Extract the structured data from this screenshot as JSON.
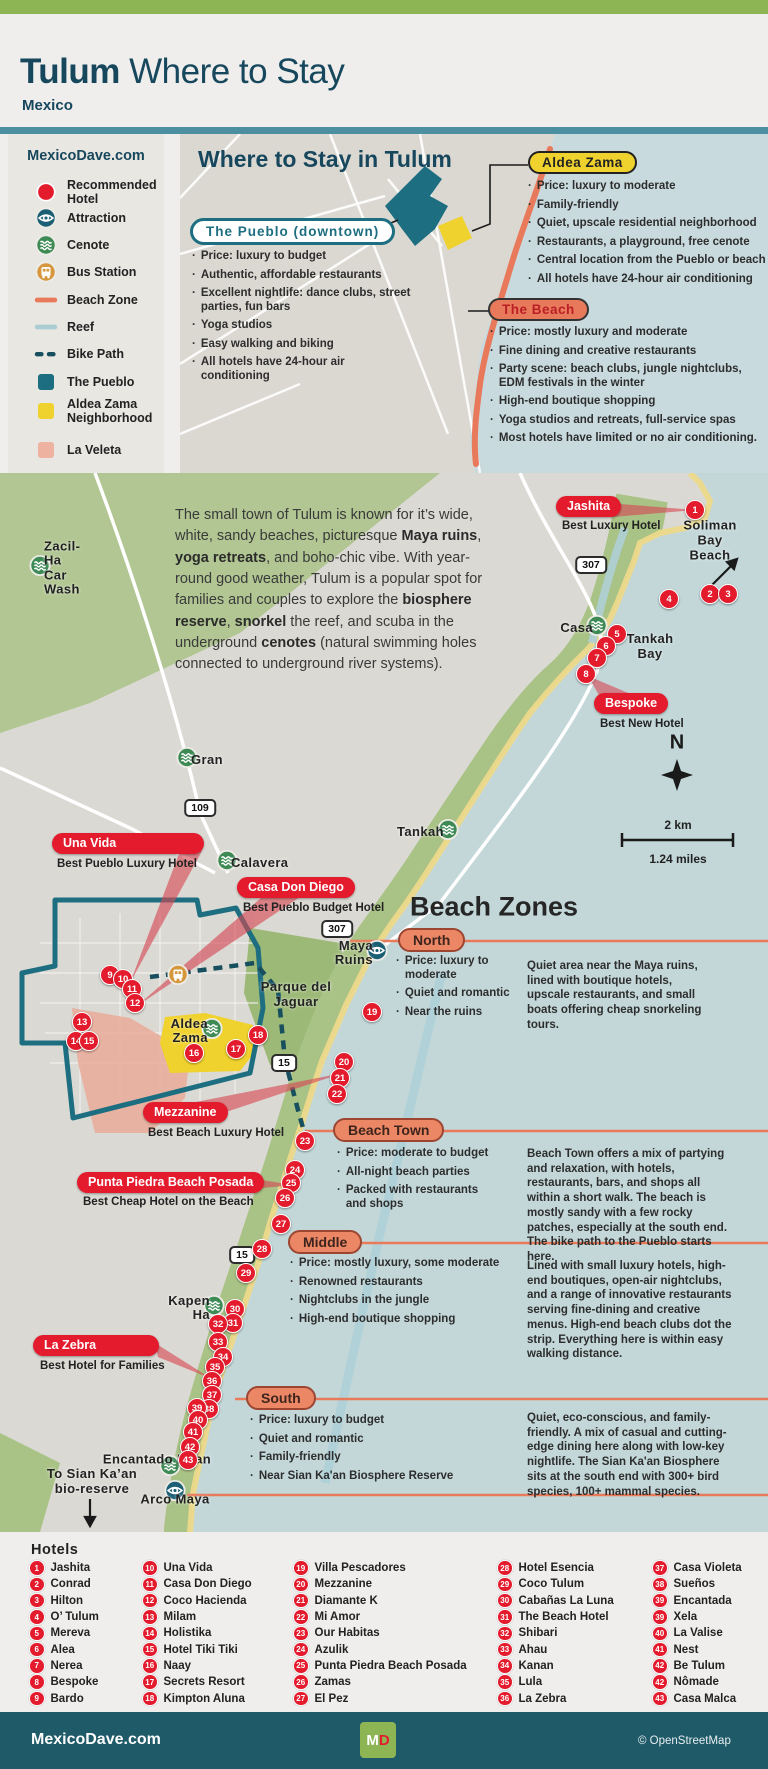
{
  "header": {
    "title_bold": "Tulum",
    "title_rest": " Where to Stay",
    "subtitle": "Mexico"
  },
  "legend": {
    "site": "MexicoDave.com",
    "items": [
      {
        "icon": "hotel",
        "label": "Recommended Hotel"
      },
      {
        "icon": "attraction",
        "label": "Attraction"
      },
      {
        "icon": "cenote",
        "label": "Cenote"
      },
      {
        "icon": "bus",
        "label": "Bus Station"
      },
      {
        "icon": "beachzone",
        "label": "Beach Zone"
      },
      {
        "icon": "reef",
        "label": "Reef"
      },
      {
        "icon": "bikepath",
        "label": "Bike Path"
      },
      {
        "icon": "pueblo",
        "label": "The Pueblo"
      },
      {
        "icon": "aldea",
        "label": "Aldea Zama Neighborhood"
      },
      {
        "icon": "veleta",
        "label": "La Veleta"
      }
    ]
  },
  "inset": {
    "title": "Where to Stay in Tulum",
    "pueblo": {
      "label": "The Pueblo (downtown)",
      "bullets": [
        "Price: luxury to budget",
        "Authentic, affordable restaurants",
        "Excellent nightlife: dance clubs, street parties, fun bars",
        "Yoga studios",
        "Easy walking and biking",
        "All hotels have 24-hour air conditioning"
      ]
    },
    "aldea": {
      "label": "Aldea Zama",
      "bullets": [
        "Price: luxury to moderate",
        "Family-friendly",
        "Quiet, upscale residential neighborhood",
        "Restaurants, a playground, free cenote",
        "Central location from the Pueblo or beach",
        "All hotels have 24-hour air conditioning"
      ]
    },
    "beach": {
      "label": "The Beach",
      "bullets": [
        "Price: mostly luxury and moderate",
        "Fine dining and creative restaurants",
        "Party scene: beach clubs, jungle nightclubs, EDM festivals in the winter",
        "High-end boutique shopping",
        "Yoga studios and retreats, full-service spas",
        "Most hotels have limited or no air conditioning."
      ]
    }
  },
  "map": {
    "intro_segments": [
      {
        "t": "The small town of Tulum is known for it’s wide, white, sandy beaches, picturesque ",
        "b": false
      },
      {
        "t": "Maya ruins",
        "b": true
      },
      {
        "t": ", ",
        "b": false
      },
      {
        "t": "yoga retreats",
        "b": true
      },
      {
        "t": ", and boho-chic vibe. With year-round good weather, Tulum is a popular spot for families and couples to explore the ",
        "b": false
      },
      {
        "t": "biosphere reserve",
        "b": true
      },
      {
        "t": ", ",
        "b": false
      },
      {
        "t": "snorkel",
        "b": true
      },
      {
        "t": " the reef, and scuba in the underground ",
        "b": false
      },
      {
        "t": "cenotes",
        "b": true
      },
      {
        "t": " (natural swimming holes connected to underground river systems).",
        "b": false
      }
    ],
    "callouts": [
      {
        "name": "Jashita",
        "sub": "Best Luxury Hotel"
      },
      {
        "name": "Bespoke",
        "sub": "Best New Hotel"
      },
      {
        "name": "Una Vida",
        "sub": "Best Pueblo Luxury Hotel"
      },
      {
        "name": "Casa Don Diego",
        "sub": "Best Pueblo Budget Hotel"
      },
      {
        "name": "Mezzanine",
        "sub": "Best Beach Luxury Hotel"
      },
      {
        "name": "Punta Piedra Beach Posada",
        "sub": "Best Cheap Hotel on the Beach"
      },
      {
        "name": "La Zebra",
        "sub": "Best Hotel for Families"
      }
    ],
    "zones_heading": "Beach Zones",
    "zones": [
      {
        "name": "North",
        "bullets": [
          "Price: luxury to moderate",
          "Quiet and romantic",
          "Near the ruins"
        ],
        "description": "Quiet area near the Maya ruins, lined with boutique hotels, upscale restaurants, and small boats offering cheap snorkeling tours."
      },
      {
        "name": "Beach Town",
        "bullets": [
          "Price: moderate to budget",
          "All-night beach parties",
          "Packed with restaurants and shops"
        ],
        "description": "Beach Town offers a mix of partying and relaxation, with hotels, restaurants, bars, and shops all within a short walk. The beach is mostly sandy with a few rocky patches, especially at the south end. The bike path to the Pueblo starts here."
      },
      {
        "name": "Middle",
        "bullets": [
          "Price: mostly luxury, some moderate",
          "Renowned restaurants",
          "Nightclubs in the jungle",
          "High-end boutique shopping"
        ],
        "description": "Lined with small luxury hotels, high-end boutiques, open-air nightclubs, and a range of innovative restaurants serving fine-dining and creative menus. High-end beach clubs dot the strip. Everything here is within easy walking distance."
      },
      {
        "name": "South",
        "bullets": [
          "Price: luxury to budget",
          "Quiet and romantic",
          "Family-friendly",
          "Near Sian Ka'an Biosphere Reserve"
        ],
        "description": "Quiet, eco-conscious, and family-friendly. A mix of casual and cutting-edge dining here along with low-key nightlife. The Sian Ka'an Biosphere sits at the south end with 300+ bird species, 100+ mammal species."
      }
    ],
    "labels": [
      {
        "t": "Soliman\nBay Beach",
        "x": 710,
        "y": 68,
        "cls": "place"
      },
      {
        "t": "Tankah\nBay",
        "x": 650,
        "y": 174,
        "cls": "place"
      },
      {
        "t": "Parque del\nJaguar",
        "x": 296,
        "y": 522,
        "cls": "place"
      },
      {
        "t": "To Sian Ka’an\nbio-reserve",
        "x": 92,
        "y": 1009,
        "cls": "place"
      },
      {
        "t": "Beach Zones",
        "x": 494,
        "y": 434,
        "cls": "zones-title"
      },
      {
        "t": "N",
        "x": 677,
        "y": 270,
        "cls": "compass-n"
      },
      {
        "t": "2 km",
        "x": 678,
        "y": 352,
        "cls": "scale-txt"
      },
      {
        "t": "1.24 miles",
        "x": 678,
        "y": 386,
        "cls": "scale-txt"
      }
    ],
    "shields": [
      {
        "t": "307",
        "x": 591,
        "y": 92
      },
      {
        "t": "109",
        "x": 200,
        "y": 335
      },
      {
        "t": "307",
        "x": 337,
        "y": 456
      },
      {
        "t": "15",
        "x": 284,
        "y": 590
      },
      {
        "t": "15",
        "x": 242,
        "y": 782
      }
    ],
    "poi": [
      {
        "type": "cenote",
        "x": 40,
        "y": 95,
        "label": "Zacil-Ha\nCar Wash",
        "side": "right"
      },
      {
        "type": "cenote",
        "x": 187,
        "y": 287,
        "label": "Gran",
        "side": "right"
      },
      {
        "type": "cenote",
        "x": 227,
        "y": 390,
        "label": "Calavera",
        "side": "right"
      },
      {
        "type": "cenote",
        "x": 597,
        "y": 155,
        "label": "Casa",
        "side": "left"
      },
      {
        "type": "cenote",
        "x": 448,
        "y": 359,
        "label": "Tankah",
        "side": "left"
      },
      {
        "type": "cenote",
        "x": 212,
        "y": 558,
        "label": "Aldea Zama",
        "side": "left"
      },
      {
        "type": "cenote",
        "x": 214,
        "y": 835,
        "label": "Kapen Ha",
        "side": "left"
      },
      {
        "type": "cenote",
        "x": 170,
        "y": 995,
        "label": "Encantado Nuan",
        "side": "above"
      },
      {
        "type": "attraction",
        "x": 377,
        "y": 480,
        "label": "Maya Ruins",
        "side": "left"
      },
      {
        "type": "attraction",
        "x": 175,
        "y": 1020,
        "label": "Arco Maya",
        "side": "below"
      },
      {
        "type": "bus",
        "x": 178,
        "y": 504,
        "label": "",
        "side": "none"
      }
    ],
    "markers": [
      [
        1,
        695,
        37
      ],
      [
        2,
        710,
        121
      ],
      [
        3,
        728,
        121
      ],
      [
        4,
        669,
        126
      ],
      [
        5,
        617,
        161
      ],
      [
        6,
        606,
        173
      ],
      [
        7,
        597,
        185
      ],
      [
        8,
        586,
        201
      ],
      [
        9,
        110,
        502
      ],
      [
        10,
        123,
        506
      ],
      [
        11,
        132,
        516
      ],
      [
        12,
        135,
        530
      ],
      [
        13,
        82,
        549
      ],
      [
        14,
        76,
        568
      ],
      [
        15,
        89,
        568
      ],
      [
        16,
        194,
        580
      ],
      [
        17,
        236,
        576
      ],
      [
        18,
        258,
        562
      ],
      [
        19,
        372,
        539
      ],
      [
        20,
        344,
        589
      ],
      [
        21,
        340,
        605
      ],
      [
        22,
        337,
        621
      ],
      [
        23,
        305,
        668
      ],
      [
        24,
        295,
        697
      ],
      [
        25,
        291,
        710
      ],
      [
        26,
        285,
        725
      ],
      [
        27,
        281,
        751
      ],
      [
        28,
        262,
        776
      ],
      [
        29,
        246,
        800
      ],
      [
        30,
        235,
        836
      ],
      [
        31,
        233,
        850
      ],
      [
        32,
        218,
        851
      ],
      [
        33,
        218,
        869
      ],
      [
        34,
        223,
        884
      ],
      [
        35,
        215,
        894
      ],
      [
        36,
        212,
        908
      ],
      [
        37,
        212,
        922
      ],
      [
        38,
        209,
        936
      ],
      [
        39,
        197,
        935
      ],
      [
        40,
        198,
        947
      ],
      [
        41,
        193,
        959
      ],
      [
        42,
        190,
        974
      ],
      [
        43,
        188,
        987
      ]
    ]
  },
  "hotels": {
    "title": "Hotels",
    "columns": [
      [
        {
          "n": "1",
          "name": "Jashita"
        },
        {
          "n": "2",
          "name": "Conrad"
        },
        {
          "n": "3",
          "name": "Hilton"
        },
        {
          "n": "4",
          "name": "O’ Tulum"
        },
        {
          "n": "5",
          "name": "Mereva"
        },
        {
          "n": "6",
          "name": "Alea"
        },
        {
          "n": "7",
          "name": "Nerea"
        },
        {
          "n": "8",
          "name": "Bespoke"
        },
        {
          "n": "9",
          "name": "Bardo"
        }
      ],
      [
        {
          "n": "10",
          "name": "Una Vida"
        },
        {
          "n": "11",
          "name": "Casa Don Diego"
        },
        {
          "n": "12",
          "name": "Coco Hacienda"
        },
        {
          "n": "13",
          "name": "Milam"
        },
        {
          "n": "14",
          "name": "Holistika"
        },
        {
          "n": "15",
          "name": "Hotel Tiki Tiki"
        },
        {
          "n": "16",
          "name": "Naay"
        },
        {
          "n": "17",
          "name": "Secrets Resort"
        },
        {
          "n": "18",
          "name": "Kimpton Aluna"
        }
      ],
      [
        {
          "n": "19",
          "name": "Villa Pescadores"
        },
        {
          "n": "20",
          "name": "Mezzanine"
        },
        {
          "n": "21",
          "name": "Diamante K"
        },
        {
          "n": "22",
          "name": "Mi Amor"
        },
        {
          "n": "23",
          "name": "Our Habitas"
        },
        {
          "n": "24",
          "name": "Azulik"
        },
        {
          "n": "25",
          "name": "Punta Piedra Beach Posada"
        },
        {
          "n": "26",
          "name": "Zamas"
        },
        {
          "n": "27",
          "name": "El Pez"
        }
      ],
      [
        {
          "n": "28",
          "name": "Hotel Esencia"
        },
        {
          "n": "29",
          "name": "Coco Tulum"
        },
        {
          "n": "30",
          "name": "Cabañas La Luna"
        },
        {
          "n": "31",
          "name": "The Beach Hotel"
        },
        {
          "n": "32",
          "name": "Shibari"
        },
        {
          "n": "33",
          "name": "Ahau"
        },
        {
          "n": "34",
          "name": "Kanan"
        },
        {
          "n": "35",
          "name": "Lula"
        },
        {
          "n": "36",
          "name": "La Zebra"
        }
      ],
      [
        {
          "n": "37",
          "name": "Casa Violeta"
        },
        {
          "n": "38",
          "name": "Sueños"
        },
        {
          "n": "39",
          "name": "Encantada"
        },
        {
          "n": "39",
          "name": "Xela"
        },
        {
          "n": "40",
          "name": "La Valise"
        },
        {
          "n": "41",
          "name": "Nest"
        },
        {
          "n": "42",
          "name": "Be Tulum"
        },
        {
          "n": "42",
          "name": "Nômade"
        },
        {
          "n": "43",
          "name": "Casa Malca"
        }
      ]
    ]
  },
  "footer": {
    "site": "MexicoDave.com",
    "logo_m": "M",
    "logo_d": "D",
    "credit": "© OpenStreetMap"
  }
}
